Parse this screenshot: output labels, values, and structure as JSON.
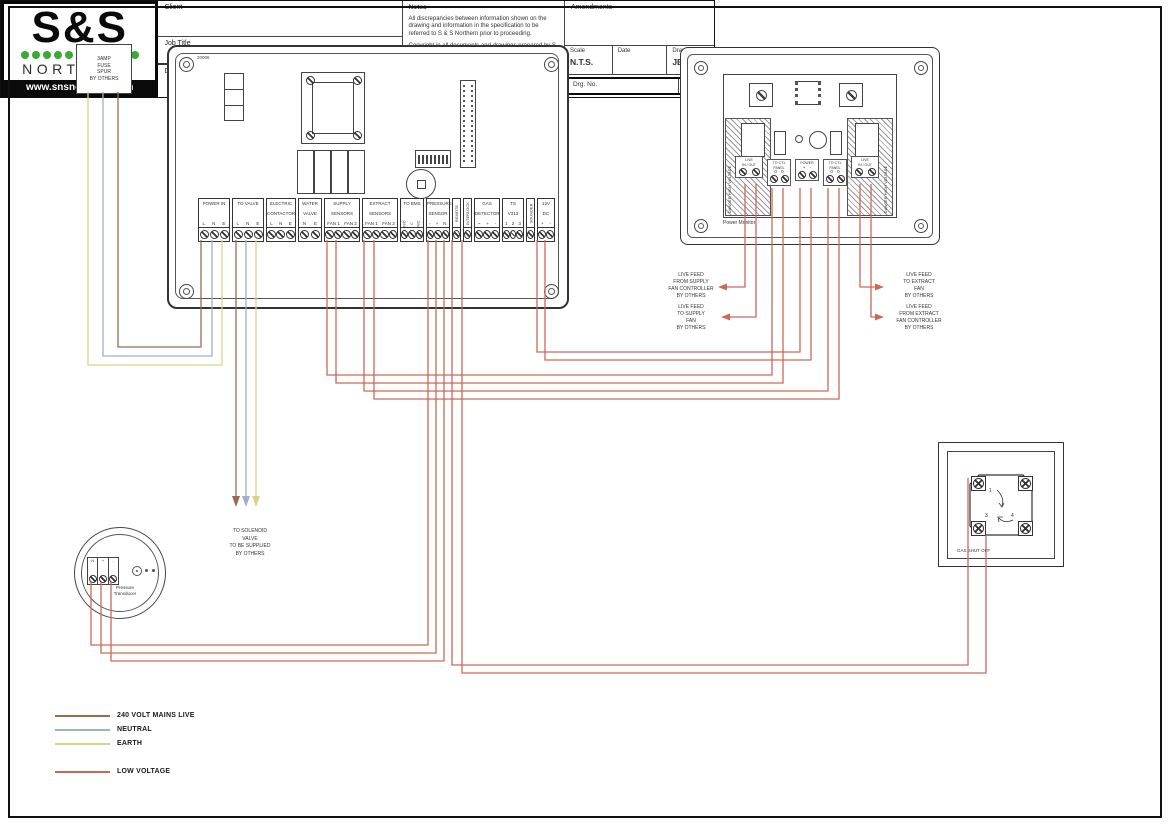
{
  "colors": {
    "mains_live": "#9b6b50",
    "neutral": "#9fb0cc",
    "earth": "#d6d488",
    "low_voltage": "#c96a57",
    "logo_green": "#3aaa35",
    "logo_red": "#e03a2f"
  },
  "fuse_spur": {
    "l1": "3AMP",
    "l2": "FUSE",
    "l3": "SPUR",
    "l4": "BY OTHERS"
  },
  "main_panel": {
    "board_no": "20006",
    "terminals": [
      {
        "line1": "POWER IN",
        "line2": "",
        "subs": [
          "L",
          "N",
          "E"
        ]
      },
      {
        "line1": "TO VALVE",
        "line2": "",
        "subs": [
          "L",
          "N",
          "E"
        ]
      },
      {
        "line1": "ELECTRIC",
        "line2": "CONTACTOR",
        "subs": [
          "L",
          "N",
          "E"
        ]
      },
      {
        "line1": "WATER",
        "line2": "VALVE",
        "subs": [
          "N",
          "E"
        ]
      },
      {
        "line1": "SUPPLY",
        "line2": "SENSORS",
        "subs": [
          "FAN 1",
          "FAN 2"
        ]
      },
      {
        "line1": "EXTRACT",
        "line2": "SENSORS",
        "subs": [
          "FAN 1",
          "FAN 2"
        ]
      },
      {
        "line1": "TO BMS",
        "line2": "",
        "subs": [
          "N/O",
          "C",
          "N/C"
        ]
      },
      {
        "line1": "PRESSURE",
        "line2": "SENSOR",
        "subs": [
          "-",
          "+",
          "N"
        ]
      },
      {
        "line1": "REMOTE",
        "line2": "",
        "subs": []
      },
      {
        "line1": "INTERLOCK",
        "line2": "",
        "subs": []
      },
      {
        "line1": "GAS",
        "line2": "DETECTOR",
        "subs": [
          "~",
          "+",
          "-"
        ]
      },
      {
        "line1": "TS",
        "line2": "V313",
        "subs": [
          "1",
          "2",
          "3"
        ]
      },
      {
        "line1": "SOUNDER",
        "line2": "",
        "subs": []
      },
      {
        "line1": "12V",
        "line2": "DC",
        "subs": [
          "+",
          "-"
        ]
      }
    ]
  },
  "power_monitor": {
    "title": "Power Monitor",
    "danger": "DANGER HIGH VOLTAGE",
    "relay_line1": "LIVE",
    "relay_line2": "IN / OUT",
    "ct_line1": "TO CT1",
    "ct_line2": "PANEL",
    "ct_subs": "0 0",
    "power_line1": "POWER",
    "power_subs": "+ -"
  },
  "feeds": {
    "from_supply": [
      "LIVE FEED",
      "FROM SUPPLY",
      "FAN CONTROLLER",
      "BY OTHERS"
    ],
    "to_supply": [
      "LIVE FEED",
      "TO SUPPLY",
      "FAN",
      "BY OTHERS"
    ],
    "to_extract": [
      "LIVE FEED",
      "TO EXTRACT",
      "FAN",
      "BY OTHERS"
    ],
    "from_extract": [
      "LIVE FEED",
      "FROM EXTRACT",
      "FAN CONTROLLER",
      "BY OTHERS"
    ]
  },
  "solenoid_note": [
    "TO SOLENOID",
    "VALVE",
    "TO BE SUPPLIED",
    "BY OTHERS"
  ],
  "gas_valve": {
    "label": "GAS SHUT OFF",
    "numbers": [
      "1",
      "3",
      "4"
    ]
  },
  "transducer": {
    "name1": "Pressure",
    "name2": "Transducer",
    "subs": [
      "N",
      "+",
      "-"
    ]
  },
  "legend": [
    {
      "label": "240 VOLT MAINS LIVE"
    },
    {
      "label": "NEUTRAL"
    },
    {
      "label": "EARTH"
    },
    {
      "label": "LOW VOLTAGE"
    }
  ],
  "title_block": {
    "client_label": "Client",
    "job_title_label": "Job Title",
    "drawing_title_label": "Drawing Title",
    "notes_label": "Notes",
    "notes_p1": "All discrepancies between information shown on the drawing and information in the specification to be referred to S & S Northern prior to proceeding.",
    "notes_p2": "Copyright in all documents and drawings prepared by S & S Northern and any work executed from these documents and drawings shall, unless otherwise agreed, remain the property of S & S Northern.",
    "amendments_label": "Amendments",
    "scale_label": "Scale",
    "scale_value": "N.T.S.",
    "date_label": "Date",
    "drawn_label": "Drawn",
    "drawn_value": "JEB",
    "drg_no_label": "Drg. No.",
    "rev_label": "Rev."
  },
  "logo": {
    "top": "S&S",
    "name": "NORTHERN",
    "url": "www.snsnorthern.com"
  }
}
